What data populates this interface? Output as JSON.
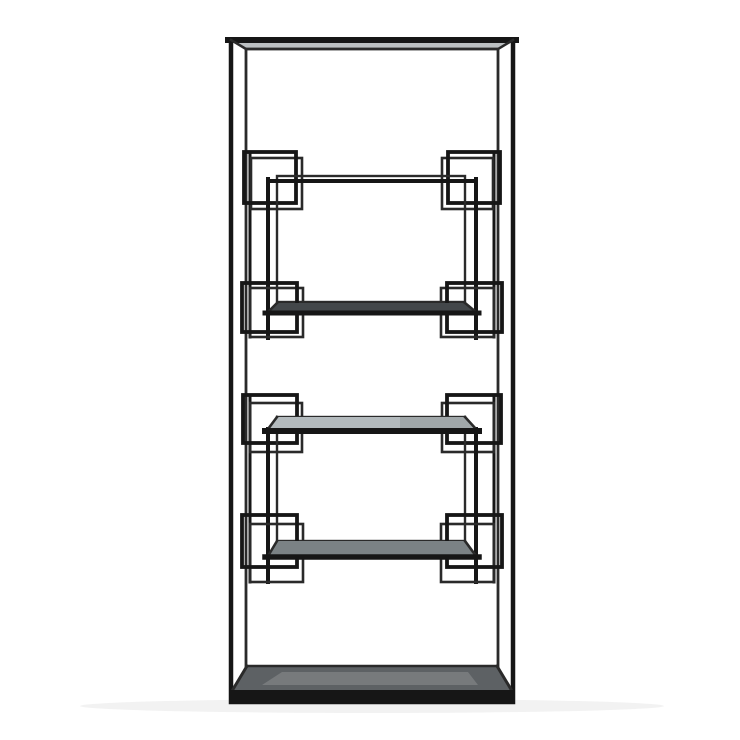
{
  "scene": {
    "subject": "Black metal etagere shelving unit with four smoked-glass shelves and geometric interlocking-square accents, photographed straight on against a white background",
    "object_type": "furniture-product-photo",
    "shelf_count": 4,
    "accent_motif": "interlocking squares at each shelf corner"
  },
  "colors": {
    "background": "#ffffff",
    "metal": "#161616",
    "metal_back": "#2a2a2a",
    "top_sheen": "#bcc0c2",
    "glass_shelf1": "#43474a",
    "glass_shelf2": "#b3babd",
    "glass_shelf3": "#7b8285",
    "glass_base": "#5d6164"
  }
}
